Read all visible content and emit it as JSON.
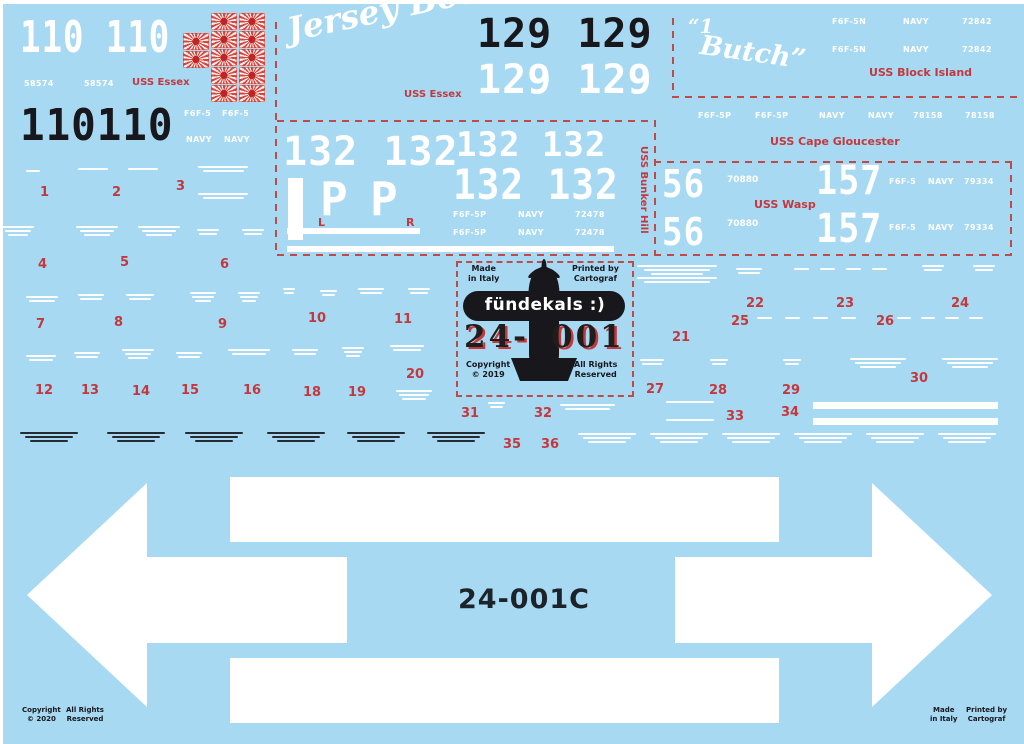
{
  "colors": {
    "bg": "#a7d9f2",
    "red": "#c4383d",
    "white": "#ffffff",
    "black": "#17171c",
    "dash": "#bf4a4a"
  },
  "sections": {
    "essex110": {
      "number": "110 110",
      "number_black": "110110",
      "buno": "58574",
      "ship": "USS Essex",
      "type": "F6F-5",
      "navy": "NAVY"
    },
    "jersey": {
      "name": "Jersey Bounce",
      "ship": "USS Essex",
      "number": "129 129"
    },
    "butch": {
      "mark": "“1",
      "name": "Butch”",
      "type": "F6F-5N",
      "navy": "NAVY",
      "buno": "72842",
      "ship": "USS Block Island"
    },
    "cape": {
      "type": "F6F-5P",
      "navy": "NAVY",
      "buno": "78158",
      "ship": "USS Cape Gloucester"
    },
    "bunker": {
      "number": "132 132",
      "letter_p": "P",
      "l": "L",
      "r": "R",
      "type": "F6F-5P",
      "navy": "NAVY",
      "buno": "72478",
      "ship": "USS Bunker Hill"
    },
    "wasp": {
      "num56": "56",
      "buno56": "70880",
      "ship": "USS Wasp",
      "num157": "157",
      "type": "F6F-5",
      "navy": "NAVY",
      "buno157": "79334"
    },
    "logo": {
      "made": "Made\nin Italy",
      "printed": "Printed by\nCartograf",
      "brand": "fündekals :)",
      "code_left": "24-",
      "code_right": "001",
      "copyright": "Copyright\n© 2019",
      "rights": "All Rights\nReserved"
    },
    "arrows": {
      "code": "24-001C"
    },
    "footer": {
      "copyright": "Copyright\n© 2020",
      "rights": "All Rights\nReserved",
      "made": "Made\nin Italy",
      "printed": "Printed by\nCartograf"
    }
  },
  "red_numbers": [
    {
      "n": "1",
      "x": 40,
      "y": 186
    },
    {
      "n": "2",
      "x": 112,
      "y": 186
    },
    {
      "n": "3",
      "x": 176,
      "y": 180
    },
    {
      "n": "4",
      "x": 38,
      "y": 258
    },
    {
      "n": "5",
      "x": 120,
      "y": 256
    },
    {
      "n": "6",
      "x": 220,
      "y": 258
    },
    {
      "n": "7",
      "x": 36,
      "y": 318
    },
    {
      "n": "8",
      "x": 114,
      "y": 316
    },
    {
      "n": "9",
      "x": 218,
      "y": 318
    },
    {
      "n": "10",
      "x": 308,
      "y": 312
    },
    {
      "n": "11",
      "x": 394,
      "y": 313
    },
    {
      "n": "12",
      "x": 35,
      "y": 384
    },
    {
      "n": "13",
      "x": 81,
      "y": 384
    },
    {
      "n": "14",
      "x": 132,
      "y": 385
    },
    {
      "n": "15",
      "x": 181,
      "y": 384
    },
    {
      "n": "16",
      "x": 243,
      "y": 384
    },
    {
      "n": "18",
      "x": 303,
      "y": 386
    },
    {
      "n": "19",
      "x": 348,
      "y": 386
    },
    {
      "n": "20",
      "x": 406,
      "y": 368
    },
    {
      "n": "21",
      "x": 672,
      "y": 331
    },
    {
      "n": "22",
      "x": 746,
      "y": 297
    },
    {
      "n": "23",
      "x": 836,
      "y": 297
    },
    {
      "n": "24",
      "x": 951,
      "y": 297
    },
    {
      "n": "25",
      "x": 731,
      "y": 315
    },
    {
      "n": "26",
      "x": 876,
      "y": 315
    },
    {
      "n": "27",
      "x": 646,
      "y": 383
    },
    {
      "n": "28",
      "x": 709,
      "y": 384
    },
    {
      "n": "29",
      "x": 782,
      "y": 384
    },
    {
      "n": "30",
      "x": 910,
      "y": 372
    },
    {
      "n": "31",
      "x": 461,
      "y": 407
    },
    {
      "n": "32",
      "x": 534,
      "y": 407
    },
    {
      "n": "33",
      "x": 726,
      "y": 410
    },
    {
      "n": "34",
      "x": 781,
      "y": 406
    },
    {
      "n": "35",
      "x": 503,
      "y": 438
    },
    {
      "n": "36",
      "x": 541,
      "y": 438
    }
  ],
  "micro_white": [
    [
      26,
      170,
      14,
      1
    ],
    [
      78,
      168,
      30,
      1
    ],
    [
      128,
      168,
      30,
      1
    ],
    [
      198,
      166,
      50,
      2
    ],
    [
      198,
      193,
      50,
      2
    ],
    [
      2,
      226,
      32,
      3
    ],
    [
      76,
      226,
      42,
      3
    ],
    [
      138,
      226,
      42,
      3
    ],
    [
      197,
      229,
      22,
      2
    ],
    [
      242,
      229,
      22,
      2
    ],
    [
      26,
      296,
      32,
      2
    ],
    [
      78,
      294,
      26,
      2
    ],
    [
      126,
      294,
      28,
      2
    ],
    [
      190,
      292,
      26,
      3
    ],
    [
      238,
      292,
      22,
      3
    ],
    [
      283,
      288,
      12,
      2
    ],
    [
      320,
      290,
      17,
      2
    ],
    [
      358,
      288,
      26,
      2
    ],
    [
      408,
      288,
      22,
      2
    ],
    [
      26,
      355,
      30,
      2
    ],
    [
      74,
      352,
      26,
      2
    ],
    [
      122,
      349,
      32,
      3
    ],
    [
      176,
      352,
      26,
      2
    ],
    [
      228,
      349,
      42,
      2
    ],
    [
      292,
      349,
      26,
      2
    ],
    [
      342,
      347,
      22,
      3
    ],
    [
      390,
      345,
      34,
      2
    ],
    [
      396,
      390,
      36,
      3
    ],
    [
      488,
      402,
      17,
      2
    ],
    [
      560,
      404,
      55,
      2
    ],
    [
      637,
      265,
      80,
      5
    ],
    [
      736,
      268,
      26,
      2
    ],
    [
      794,
      268,
      15,
      1
    ],
    [
      820,
      268,
      15,
      1
    ],
    [
      846,
      268,
      15,
      1
    ],
    [
      872,
      268,
      15,
      1
    ],
    [
      922,
      265,
      22,
      2
    ],
    [
      973,
      265,
      22,
      2
    ],
    [
      757,
      317,
      15,
      1
    ],
    [
      785,
      317,
      15,
      1
    ],
    [
      813,
      317,
      15,
      1
    ],
    [
      841,
      317,
      15,
      1
    ],
    [
      897,
      317,
      14,
      1
    ],
    [
      921,
      317,
      14,
      1
    ],
    [
      945,
      317,
      14,
      1
    ],
    [
      969,
      317,
      14,
      1
    ],
    [
      640,
      359,
      24,
      2
    ],
    [
      710,
      359,
      18,
      2
    ],
    [
      783,
      359,
      18,
      2
    ],
    [
      850,
      358,
      56,
      3
    ],
    [
      942,
      358,
      56,
      3
    ],
    [
      666,
      401,
      48,
      1
    ],
    [
      666,
      419,
      48,
      1
    ],
    [
      578,
      433,
      58,
      3
    ],
    [
      650,
      433,
      58,
      3
    ],
    [
      722,
      433,
      58,
      3
    ],
    [
      794,
      433,
      58,
      3
    ],
    [
      866,
      433,
      58,
      3
    ],
    [
      938,
      433,
      58,
      3
    ]
  ],
  "micro_black": [
    [
      20,
      432,
      58,
      3
    ],
    [
      107,
      432,
      58,
      3
    ],
    [
      185,
      432,
      58,
      3
    ],
    [
      267,
      432,
      58,
      3
    ],
    [
      347,
      432,
      58,
      3
    ],
    [
      427,
      432,
      58,
      3
    ]
  ],
  "bars": [
    [
      288,
      178,
      15,
      62
    ],
    [
      287,
      228,
      133,
      6
    ],
    [
      287,
      246,
      327,
      6
    ],
    [
      813,
      402,
      185,
      7
    ],
    [
      813,
      418,
      185,
      7
    ]
  ],
  "flags": {
    "cols": [
      {
        "x": 183,
        "y": 33,
        "n": 2
      },
      {
        "x": 211,
        "y": 13,
        "n": 5
      },
      {
        "x": 239,
        "y": 13,
        "n": 5
      }
    ],
    "w": 26,
    "h": 18
  }
}
